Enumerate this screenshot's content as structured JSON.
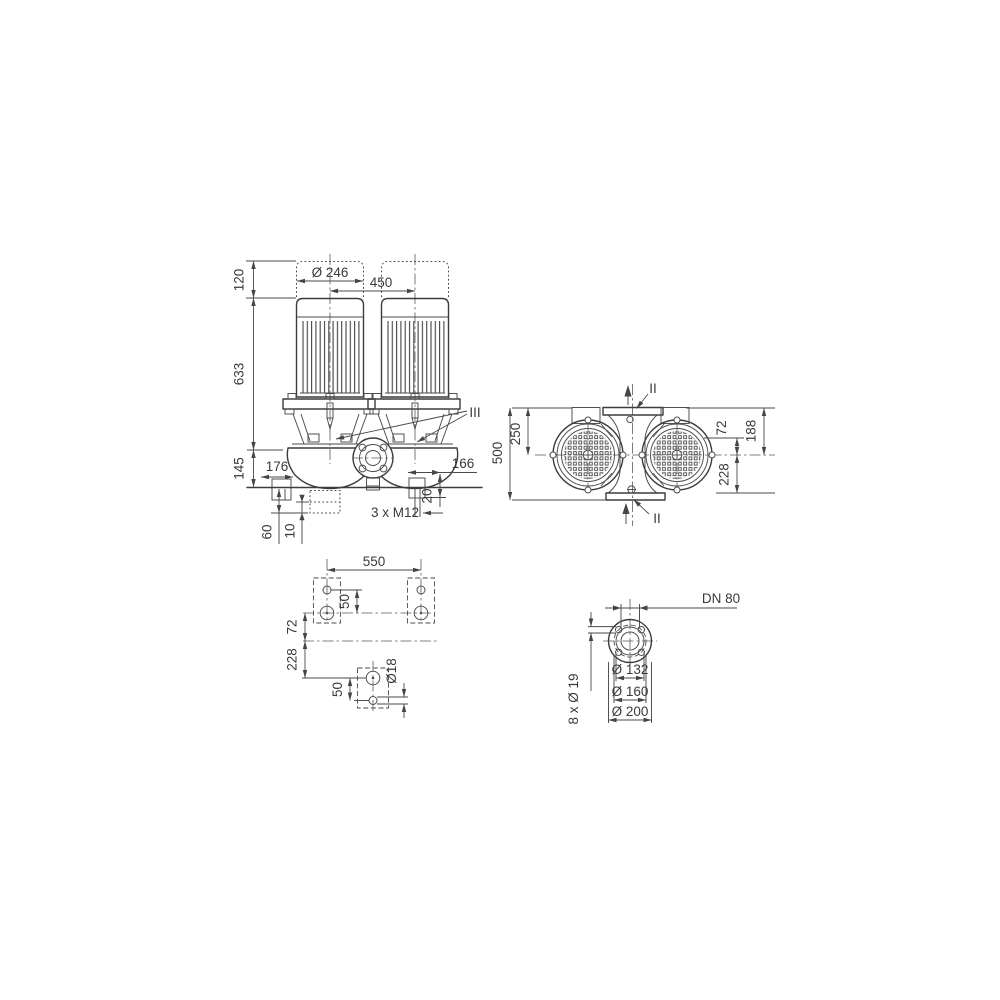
{
  "colors": {
    "background": "#ffffff",
    "line": "#474747",
    "outline": "#3a3a3a",
    "text": "#3a3a3a"
  },
  "front_view": {
    "dim_motor_extension": "120",
    "dim_total_height": "633",
    "dim_base_height": "145",
    "dim_motor_diameter": "Ø 246",
    "dim_motor_spacing": "450",
    "dim_left_offset": "176",
    "dim_right_offset": "166",
    "dim_foot_height": "20",
    "tapped_holes_label": "3 x M12",
    "dim_foundation_depth": "60",
    "dim_pad_thickness": "10",
    "section_mark": "III"
  },
  "top_view": {
    "dim_port_to_port": "500",
    "dim_port_to_axis": "250",
    "dim_axis_offset": "72",
    "dim_flange_to_axis": "188",
    "dim_axis_to_foot": "228",
    "section_mark_top": "II",
    "section_mark_bottom": "II"
  },
  "foundation_view": {
    "dim_bolt_spacing": "550",
    "dim_hole_pitch_top": "50",
    "dim_axis_offset": "72",
    "dim_axis_to_foot": "228",
    "dim_hole_pitch_bottom": "50",
    "dim_hole_diameter": "Ø18"
  },
  "flange_view": {
    "nominal_diameter": "DN 80",
    "dim_raised_face": "Ø 132",
    "dim_bolt_circle": "Ø 160",
    "dim_outer_diameter": "Ø 200",
    "bolt_holes_label": "8 x Ø 19"
  }
}
